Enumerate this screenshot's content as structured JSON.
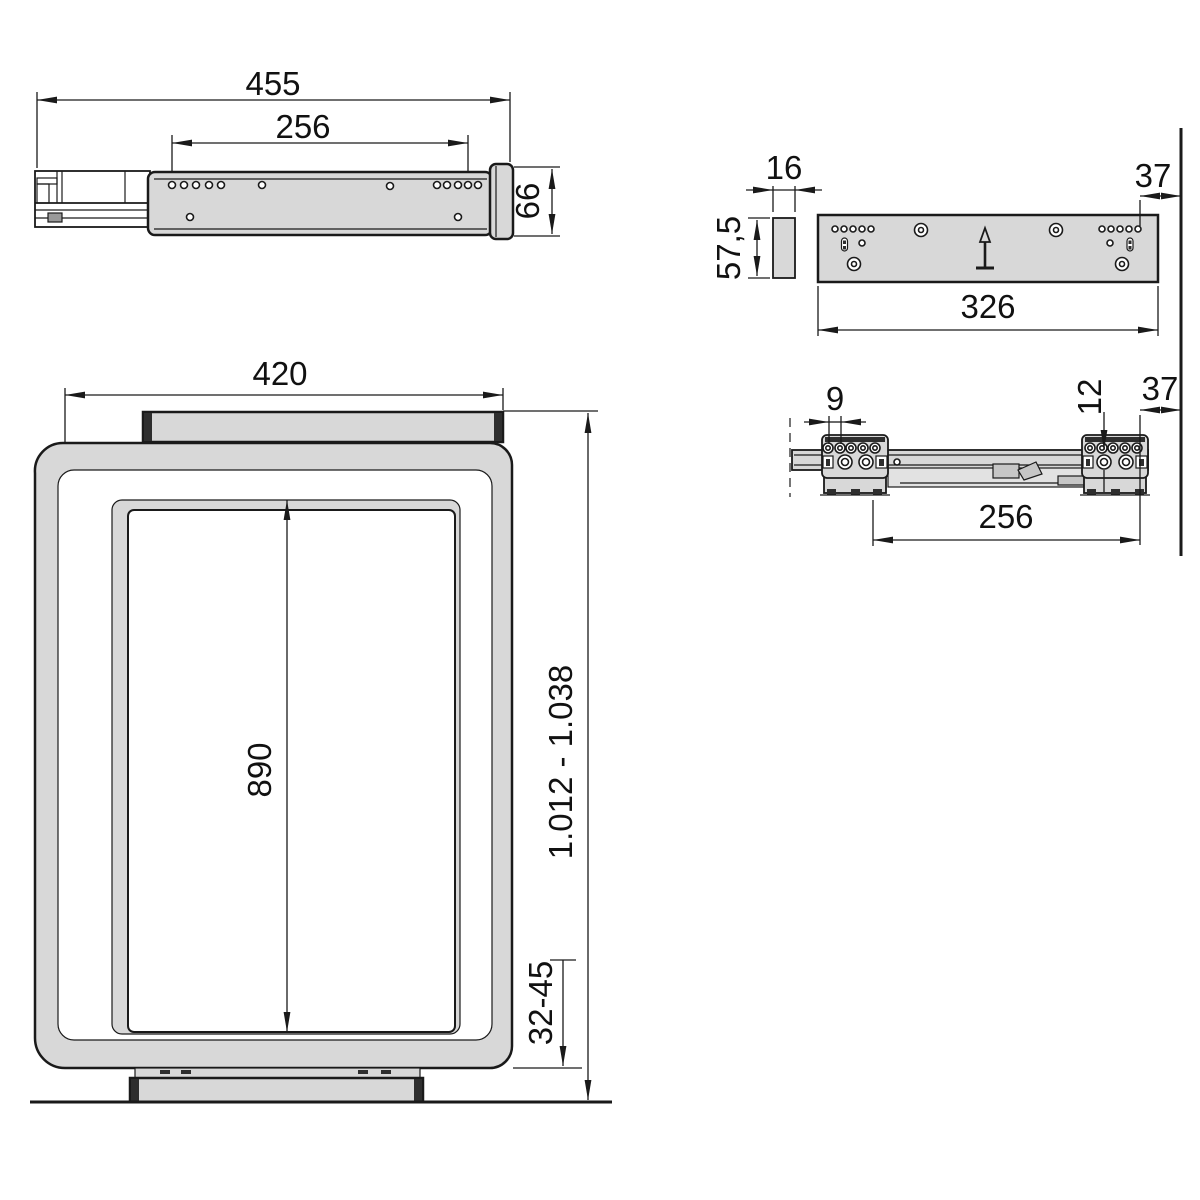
{
  "drawing_type": "technical-dimensional-drawing",
  "views": {
    "slide_side_view": {
      "description": "drawer slide side view",
      "dims": {
        "total_length": "455",
        "hole_spacing": "256",
        "height": "66"
      }
    },
    "back_panel_view": {
      "description": "mounting panel rear view with spacer plate",
      "dims": {
        "spacer_width": "16",
        "spacer_height": "57,5",
        "panel_width": "326",
        "side_offset": "37"
      }
    },
    "slide_top_view": {
      "description": "slide rail top view with mounting brackets",
      "dims": {
        "hole_pitch": "9",
        "hole_diameter": "12",
        "side_offset": "37",
        "bracket_spacing": "256"
      }
    },
    "frame_front_view": {
      "description": "pull-out frame front view",
      "dims": {
        "frame_width": "420",
        "inner_height": "890",
        "installation_height": "1.012 - 1.038",
        "bottom_clearance": "32-45"
      }
    }
  },
  "colors": {
    "part_fill": "#d8d8d8",
    "line_color": "#1a1a1a",
    "background": "#ffffff",
    "dark_detail": "#2e2e2e"
  }
}
